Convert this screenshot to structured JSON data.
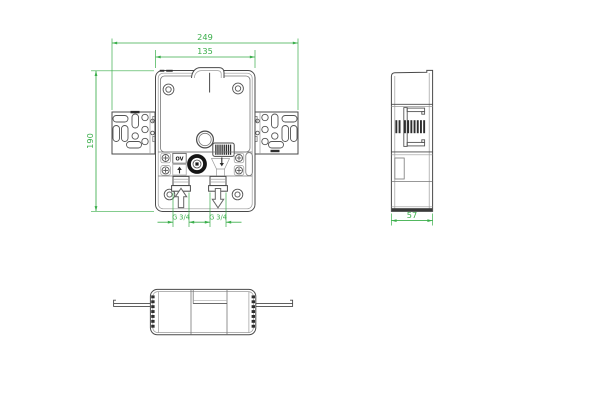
{
  "drawing": {
    "background_color": "#ffffff",
    "object_line_color": "#4a4a4a",
    "dimension_color": "#3aae4a",
    "dimensions": {
      "overall_width": "249",
      "body_width": "135",
      "overall_height": "190",
      "depth": "57",
      "inlet_thread": "G 3/4",
      "outlet_thread": "G 3/4"
    },
    "labels": {
      "valve_marking": "OV"
    },
    "icons": {
      "inlet_flow": "up-arrow",
      "outlet_flow": "down-arrow"
    }
  }
}
